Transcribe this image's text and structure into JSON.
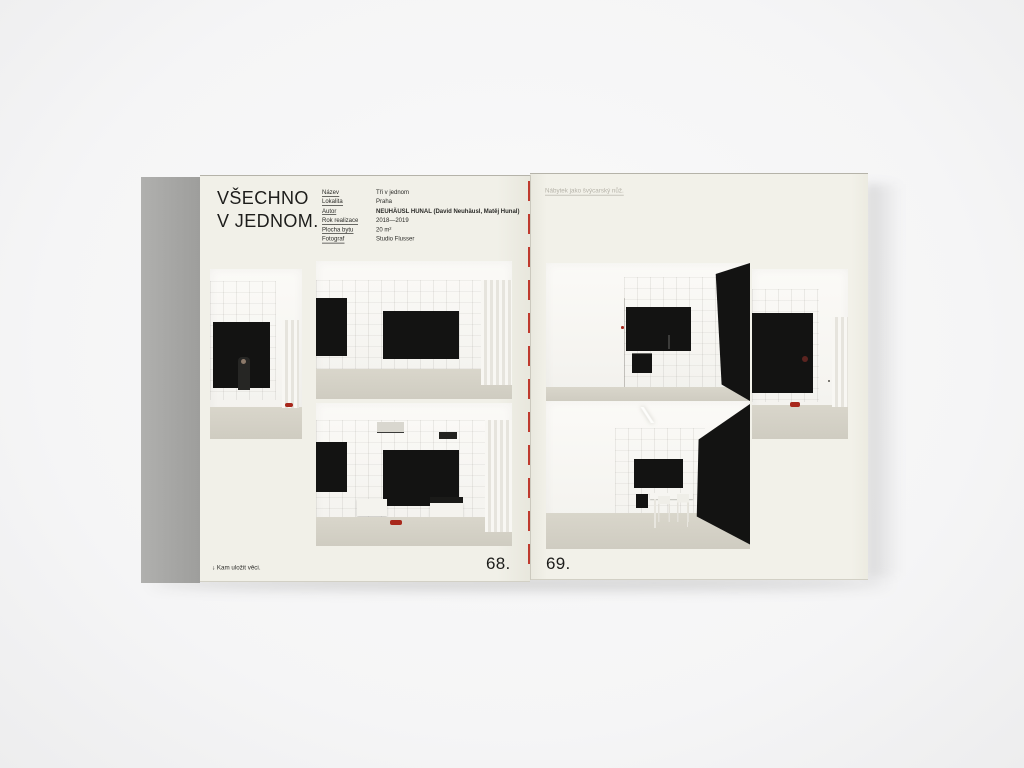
{
  "book": {
    "left_page": {
      "title_line1": "VŠECHNO",
      "title_line2": "V JEDNOM.",
      "meta": [
        {
          "label": "Název",
          "value": "Tři v jednom"
        },
        {
          "label": "Lokalita",
          "value": "Praha"
        },
        {
          "label": "Autor",
          "value": "NEUHÄUSL HUNAL (David Neuhäusl, Matěj Hunal)"
        },
        {
          "label": "Rok realizace",
          "value": "2018—2019"
        },
        {
          "label": "Plocha bytu",
          "value": "20 m²"
        },
        {
          "label": "Fotograf",
          "value": "Studio Flusser"
        }
      ],
      "footer_note": "↓ Kam uložit věci.",
      "page_number": "68."
    },
    "right_page": {
      "header_note": "Nábytek jako švýcarský nůž.",
      "page_number": "69."
    },
    "colors": {
      "background": "#f6f6f7",
      "page_cream": "#f1f0e8",
      "cover_edge_gray": "#a7a7a5",
      "stitch_red": "#bf3a2e",
      "slippers_red": "#a8281c",
      "photo_black": "#131312",
      "floor_beige": "#d6d3c8"
    }
  }
}
